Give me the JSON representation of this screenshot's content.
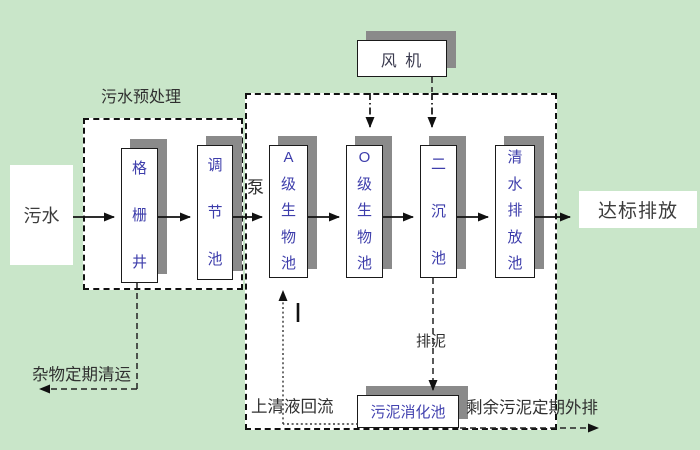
{
  "title": "污水处理工艺流程图",
  "colors": {
    "background": "#c9e6c9",
    "zone_fill": "#ffffff",
    "shadow": "#8a8a8a",
    "tank_text": "#3d3dab",
    "line": "#111111"
  },
  "nodes": {
    "source": "污水",
    "grid_well": "格栅井",
    "regulating": "调节池",
    "tank_a": "A级生物池",
    "tank_o": "O级生物池",
    "secondary": "二沉池",
    "clean_discharge": "清水排放池",
    "fan": "风 机",
    "digester": "污泥消化池",
    "outfall": "达标排放"
  },
  "annotations": {
    "pretreat_title": "污水预处理",
    "pump": "泵",
    "debris_removal": "杂物定期清运",
    "supernatant_return": "上清液回流",
    "sludge_drain": "排泥",
    "excess_sludge": "剩余污泥定期外排"
  }
}
